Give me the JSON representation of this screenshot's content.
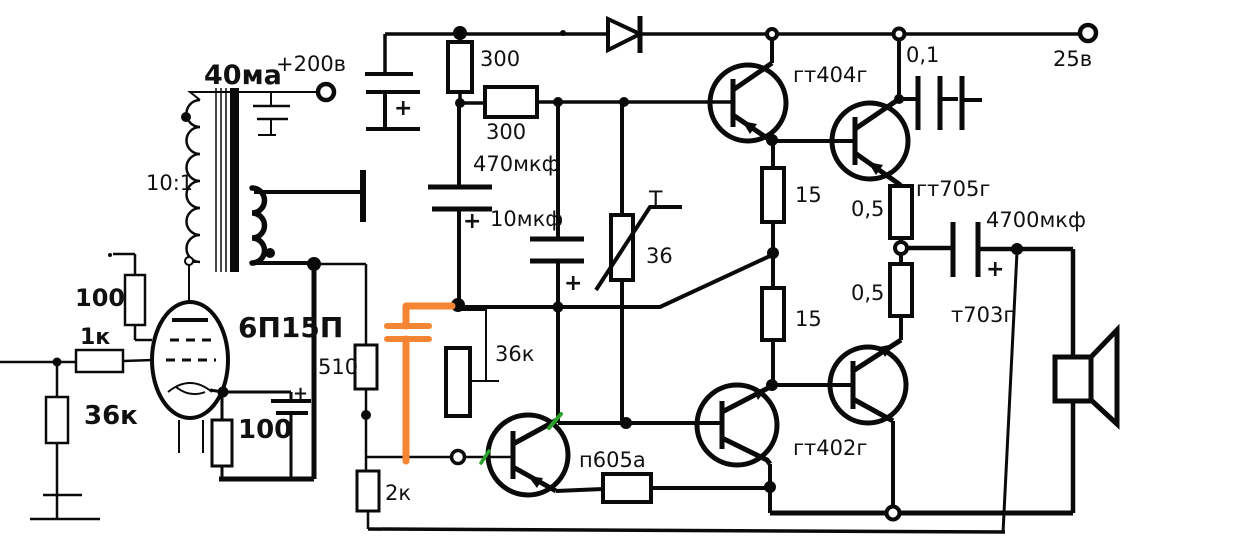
{
  "colors": {
    "ink": "#0a0a0a",
    "highlight_orange": "#f58433",
    "mark_green": "#2ca02c",
    "background": "#ffffff"
  },
  "labels": {
    "anode_current": "40ма",
    "plate_supply": "+200в",
    "transformer_ratio": "10:1",
    "r_screen": "100",
    "r_grid": "1к",
    "r_input": "36к",
    "tube": "6П15П",
    "r_cathode": "100",
    "r_feedback": "510",
    "r_bias_lower": "2к",
    "r_filter_top": "300",
    "r_filter_mid": "300",
    "c_filter": "470мкф",
    "c_bootstrap": "10мкф",
    "thermistor_letter": "T",
    "thermistor_value": "36",
    "r_base_mid": "36к",
    "q_upper_driver": "гт404г",
    "c_snubber": "0,1",
    "output_voltage": "25в",
    "r_collector_upper": "15",
    "r_emitter_upper": "0,5",
    "q_upper_output": "гт705г",
    "c_output": "4700мкф",
    "r_emitter_lower": "0,5",
    "r_collector_lower": "15",
    "q_lower_output": "т703г",
    "q_lower_driver": "гт402г",
    "q_input": "п605а",
    "plus": "+"
  }
}
